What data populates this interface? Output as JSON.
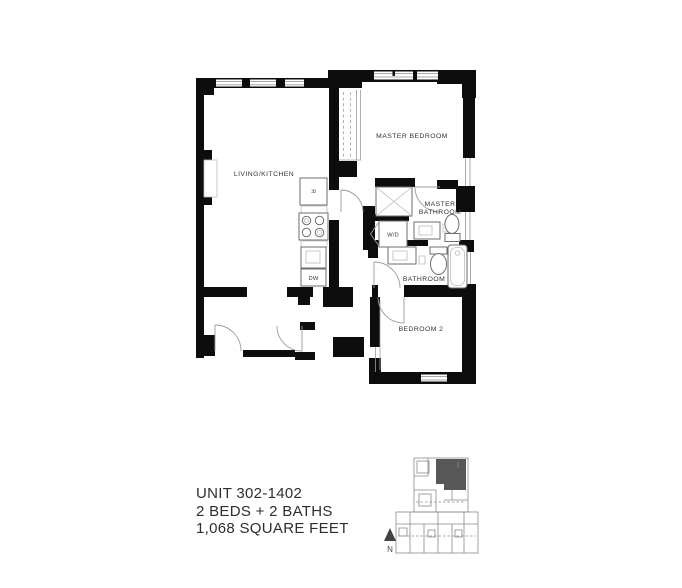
{
  "plan": {
    "rooms": {
      "living_kitchen": "LIVING/KITCHEN",
      "master_bedroom": "MASTER BEDROOM",
      "master_bathroom_line1": "MASTER",
      "master_bathroom_line2": "BATHROOM",
      "bathroom": "BATHROOM",
      "bedroom2": "BEDROOM 2"
    },
    "appliances": {
      "refrigerator": "R",
      "washer_dryer": "W/D",
      "dishwasher": "DW"
    }
  },
  "info": {
    "unit": "UNIT 302-1402",
    "beds_baths": "2 BEDS + 2 BATHS",
    "area": "1,068 SQUARE FEET"
  },
  "key_plan": {
    "north_label": "N"
  },
  "colors": {
    "wall": "#0d0d0d",
    "line": "#a9a9a9",
    "fixture": "#6e6e6e",
    "text": "#2e2e2e",
    "key": "#8a8a8a",
    "highlight_unit": "#575757"
  }
}
